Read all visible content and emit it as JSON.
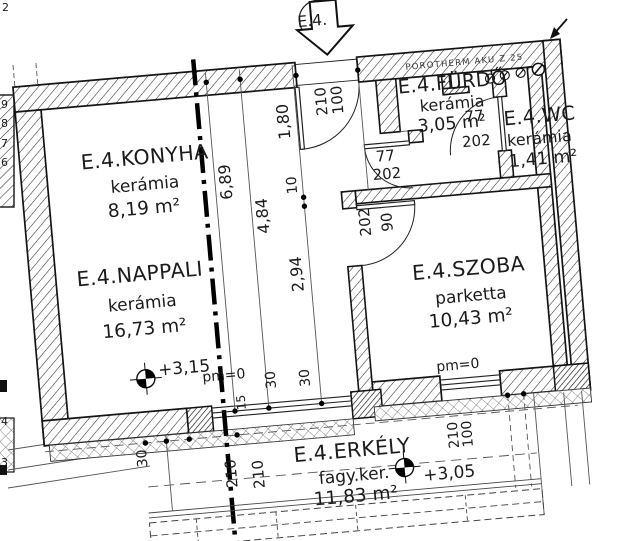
{
  "plan_title": "E.4.",
  "wall_note": "POROTHERM AKU Z 25",
  "rooms": [
    {
      "name": "E.4.KONYHA",
      "finish": "kerámia",
      "area": "8,19 m²"
    },
    {
      "name": "E.4.NAPPALI",
      "finish": "kerámia",
      "area": "16,73 m²"
    },
    {
      "name": "E.4.FÜRDŐ",
      "finish": "kerámia",
      "area": "3,05 m²"
    },
    {
      "name": "E.4.WC",
      "finish": "kerámia",
      "area": "1,41 m²"
    },
    {
      "name": "E.4.SZOBA",
      "finish": "parketta",
      "area": "10,43 m²"
    },
    {
      "name": "E.4.ERKÉLY",
      "finish": "fagy.ker.",
      "area": "11,83 m²"
    }
  ],
  "levels": {
    "nappali": "+3,15",
    "erkely": "+3,05"
  },
  "doors": {
    "entry": {
      "w": "100",
      "h": "210"
    },
    "furdo": {
      "w": "77",
      "h": "202"
    },
    "wc": {
      "w": "77",
      "h": "202"
    },
    "szoba": {
      "w": "90",
      "h": "202"
    }
  },
  "window_szoba": {
    "w": "100",
    "h": "210"
  },
  "dims": {
    "total": "6,89",
    "a": "4,84",
    "b": "2,94",
    "c": "1,80",
    "small": "10",
    "t30a": "30",
    "t30b": "30",
    "t30c": "30",
    "t15": "15",
    "w210a": "210",
    "w210b": "210",
    "pm0_left": "pm=0",
    "pm0_right": "pm=0"
  },
  "edge_digits": [
    "9",
    "8",
    "7",
    "6",
    "4",
    "3"
  ],
  "corner_digit": "2",
  "colors": {
    "ink": "#1b1b1b",
    "paper": "#ffffff"
  }
}
